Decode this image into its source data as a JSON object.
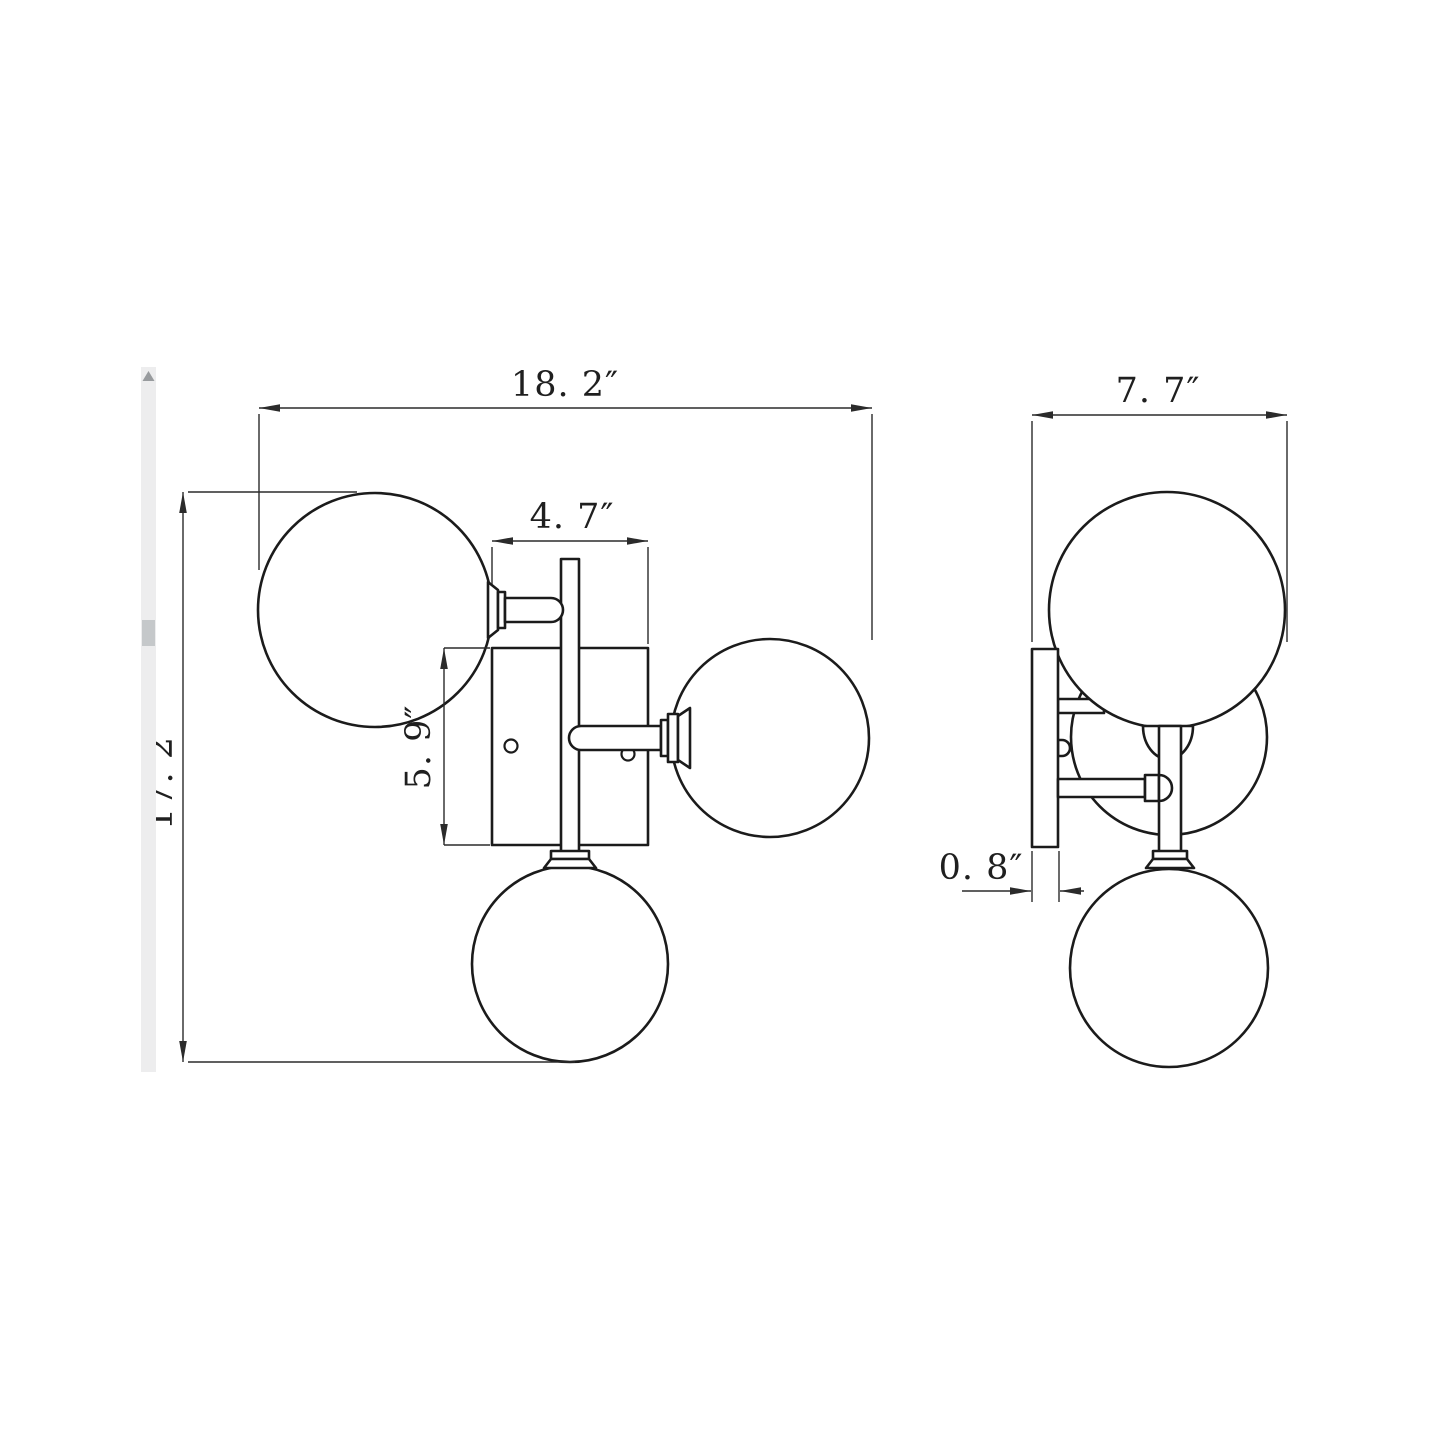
{
  "drawing": {
    "kind": "technical-dimension-drawing",
    "subject": "three-globe wall sconce line drawing, front and side orthographic views",
    "background_color": "#ffffff",
    "line_color": "#1b1b1b",
    "units": "inches",
    "views": [
      {
        "id": "front-view",
        "globe_count": 3,
        "dimension_count": 4
      },
      {
        "id": "side-view",
        "globe_count": 3,
        "dimension_count": 2
      }
    ]
  },
  "dims": {
    "front_width": "18. 2″",
    "front_height": "17. 2″",
    "backplate_width": "4. 7″",
    "backplate_height": "5. 9″",
    "side_depth": "7. 7″",
    "plate_thickness": "0. 8″"
  },
  "scrollbar": {
    "orientation": "vertical",
    "track_color": "#ededee",
    "thumb_color": "#c5c8ca",
    "arrow_color": "#989b9e"
  }
}
